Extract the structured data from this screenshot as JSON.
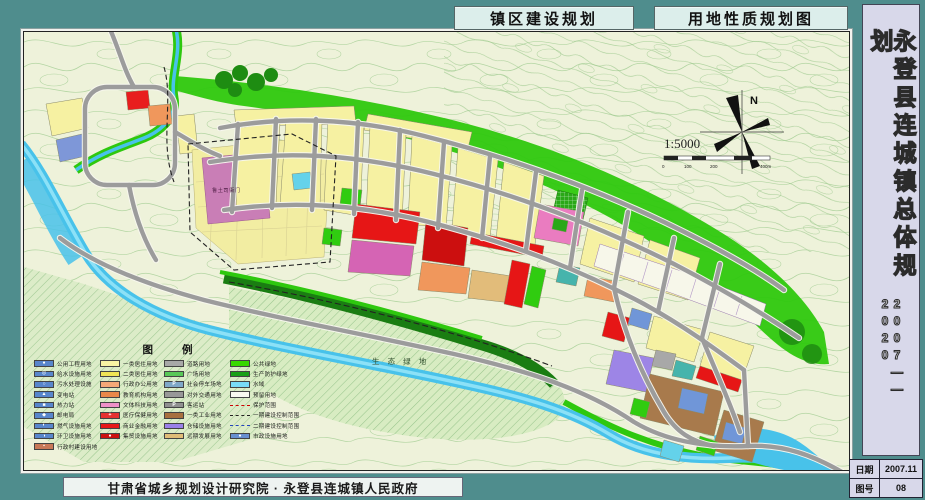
{
  "titles": {
    "left_tab": "镇区建设规划",
    "right_tab": "用地性质规划图"
  },
  "sidebar": {
    "title_vertical": "永登县连城镇总体规划",
    "years": "2007——2020",
    "info_table": {
      "rows": [
        {
          "label": "日期",
          "value": "2007.11"
        },
        {
          "label": "图号",
          "value": "08"
        }
      ]
    }
  },
  "footer": {
    "credit": "甘肃省城乡规划设计研究院 · 永登县连城镇人民政府"
  },
  "map": {
    "labels": {
      "heritage_site": "鲁土司衙门",
      "eco_green": "生 态 绿 地",
      "north": "N",
      "scale_text": "1:5000",
      "ticks": [
        "0",
        "100",
        "200",
        "400m"
      ]
    },
    "key_colors": {
      "frame_teal": "#4f8d8d",
      "map_ground": "#eef2da",
      "water": "#48c2ea",
      "green_space": "#2ec80e",
      "residential_yellow": "#f6f1a2",
      "commercial_red": "#e61616",
      "industrial_brown": "#a87a4c",
      "warehouse_purple": "#9d85e6",
      "heritage_mauve": "#c97eb6"
    }
  },
  "legend": {
    "title": "图    例",
    "columns": [
      [
        {
          "label": "一类居住用地",
          "color": "#f8f4a4"
        },
        {
          "label": "二类居住用地",
          "color": "#f0e455"
        },
        {
          "label": "行政办公用地",
          "color": "#f4a878"
        },
        {
          "label": "教育机构用地",
          "color": "#e8884a"
        },
        {
          "label": "文体科技用地",
          "color": "#f090c8"
        },
        {
          "label": "医疗保健用地",
          "color": "#e63030",
          "symbol": "+"
        },
        {
          "label": "商业金融用地",
          "color": "#e61818"
        },
        {
          "label": "集贸设施用地",
          "color": "#cc1010",
          "symbol": "●"
        }
      ],
      [
        {
          "label": "道路用地",
          "color": "#a8a8a8"
        },
        {
          "label": "广场用地",
          "color": "#58c858",
          "pattern": "dots"
        },
        {
          "label": "社会停车场地",
          "color": "#7fa8c8",
          "symbol": "P"
        },
        {
          "label": "对外交通用地",
          "color": "#989898"
        },
        {
          "label": "客运站",
          "color": "#909090",
          "symbol": "P"
        },
        {
          "label": "一类工业用地",
          "color": "#a87040"
        },
        {
          "label": "仓储设施用地",
          "color": "#9a80e8"
        },
        {
          "label": "远期发展用地",
          "color": "#e0bc78"
        }
      ],
      [
        {
          "label": "公共绿地",
          "color": "#38d800",
          "pattern": "grid"
        },
        {
          "label": "生产防护绿地",
          "color": "#18a018"
        },
        {
          "label": "水域",
          "color": "#78dcf8"
        },
        {
          "label": "预留用地",
          "color": "#f8f8f0"
        },
        {
          "label": "保护范围",
          "line": "dashed-red"
        },
        {
          "label": "一期建设控制范围",
          "line": "dashdot-black"
        },
        {
          "label": "二期建设控制范围",
          "line": "dash-blue"
        },
        {
          "label": "市政设施用地",
          "color": "#6890d0",
          "symbol": "●"
        }
      ],
      [
        {
          "label": "公用工程用地",
          "color": "#5886cc",
          "symbol": "●"
        },
        {
          "label": "给水设施用地",
          "color": "#5886cc",
          "symbol": "◎"
        },
        {
          "label": "污水处理设施",
          "color": "#5886cc",
          "symbol": "○"
        },
        {
          "label": "变电站",
          "color": "#5886cc",
          "symbol": "▲"
        },
        {
          "label": "热力站",
          "color": "#5886cc",
          "symbol": "■"
        },
        {
          "label": "邮电局",
          "color": "#5886cc",
          "symbol": "◆"
        },
        {
          "label": "燃气设施用地",
          "color": "#5886cc",
          "symbol": "◐"
        },
        {
          "label": "环卫设施用地",
          "color": "#5886cc",
          "symbol": "◑"
        },
        {
          "label": "行政村建设用地",
          "color": "#c87858",
          "symbol": "▪"
        }
      ]
    ]
  }
}
